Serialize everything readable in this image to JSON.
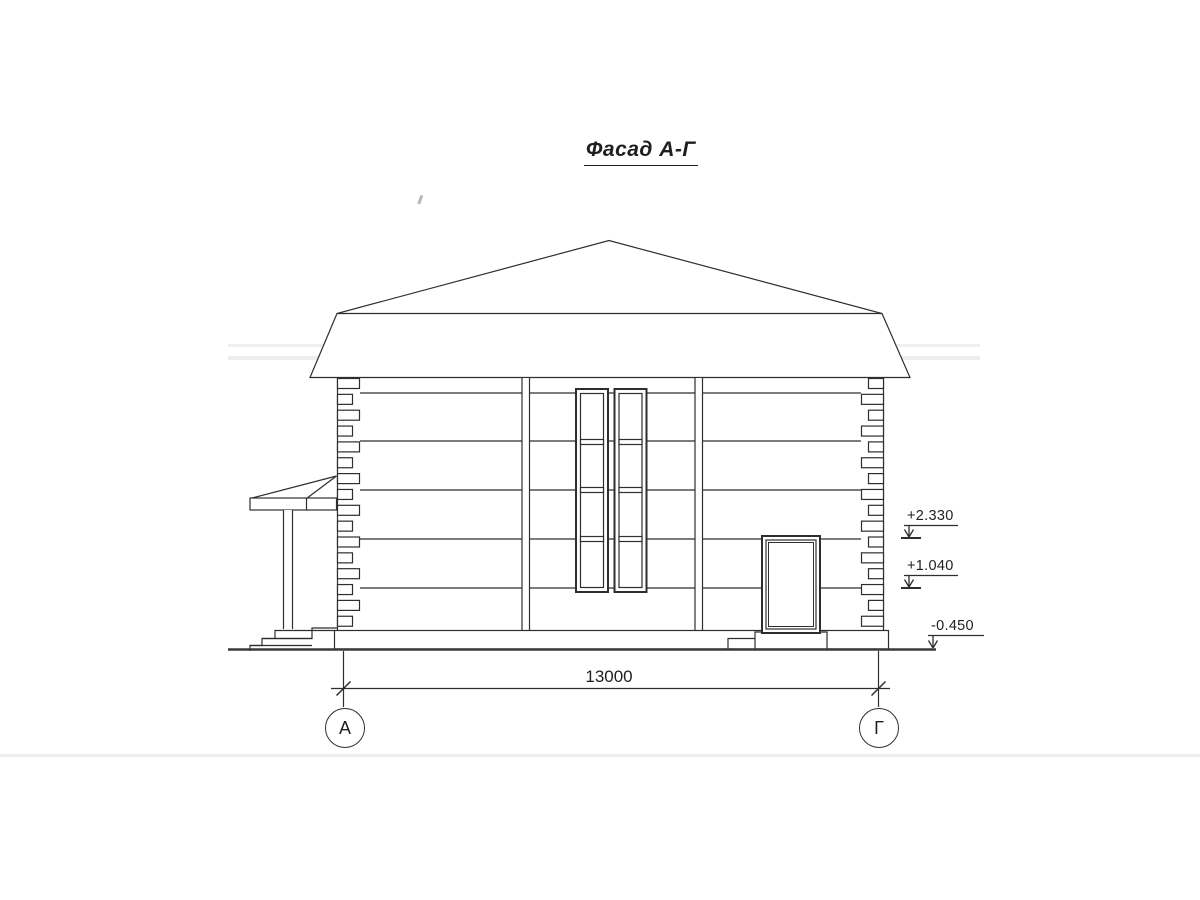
{
  "drawing": {
    "title": "Фасад А-Г",
    "dimension": {
      "value": "13000"
    },
    "axis_markers": [
      {
        "label": "А"
      },
      {
        "label": "Г"
      }
    ],
    "elevation_marks": [
      {
        "label": "+2.330"
      },
      {
        "label": "+1.040"
      },
      {
        "label": "-0.450"
      }
    ],
    "colors": {
      "line": "#2e2e2e",
      "paper": "#ffffff",
      "streak": "#dcdcdc"
    }
  }
}
